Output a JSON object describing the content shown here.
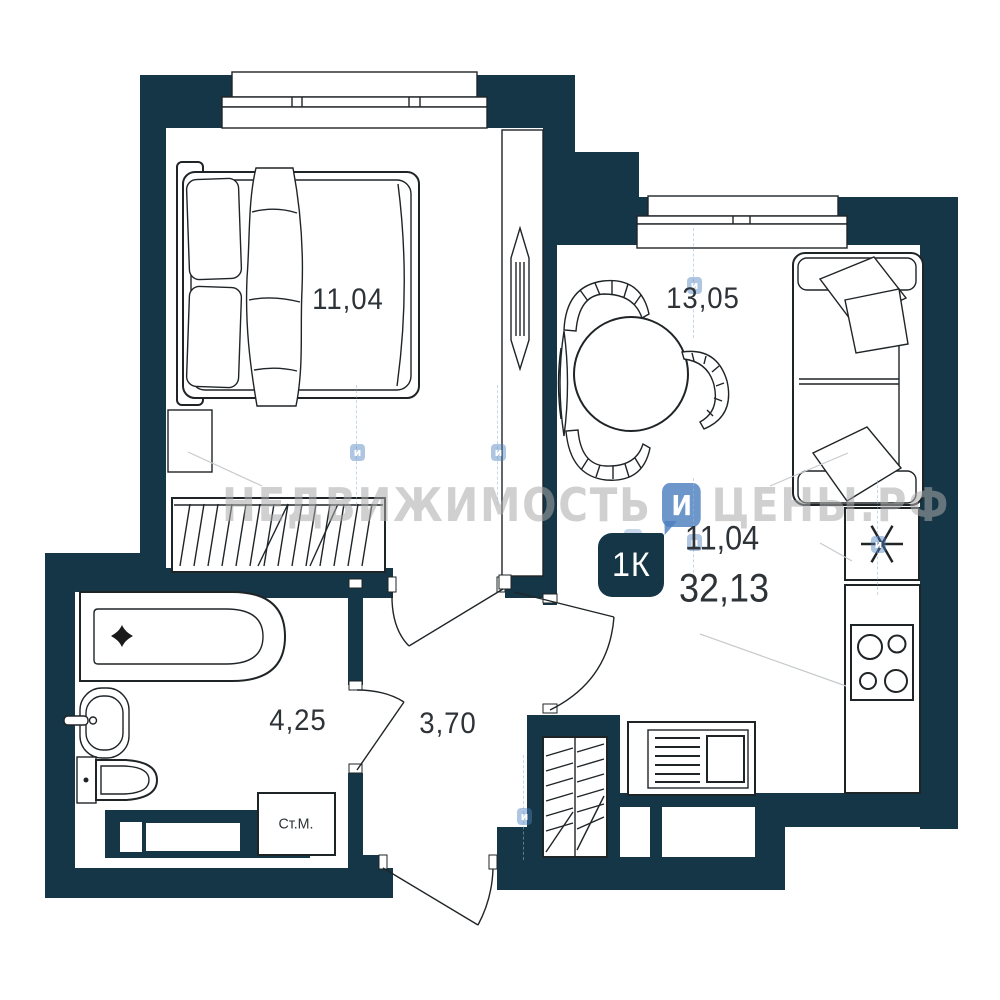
{
  "plan": {
    "type_badge": {
      "label": "1К",
      "area_first": "11,04",
      "area_total": "32,13"
    },
    "rooms": [
      {
        "name": "bedroom",
        "area_label": "11,04"
      },
      {
        "name": "living-kitchen",
        "area_label": "13,05"
      },
      {
        "name": "bathroom",
        "area_label": "4,25"
      },
      {
        "name": "hallway",
        "area_label": "3,70"
      }
    ],
    "appliances": {
      "washing_machine_label": "Ст.М."
    },
    "watermark": {
      "word_left": "НЕДВИЖИМОСТЬ",
      "word_right": "ЦЕНЫ.РФ",
      "logo_letter": "И",
      "tile_letter": "и"
    },
    "colors": {
      "wall": "#153646",
      "logo_blue": "#4d80bf",
      "watermark_gray": "#a9a9a9",
      "ink": "#2e3338"
    }
  }
}
